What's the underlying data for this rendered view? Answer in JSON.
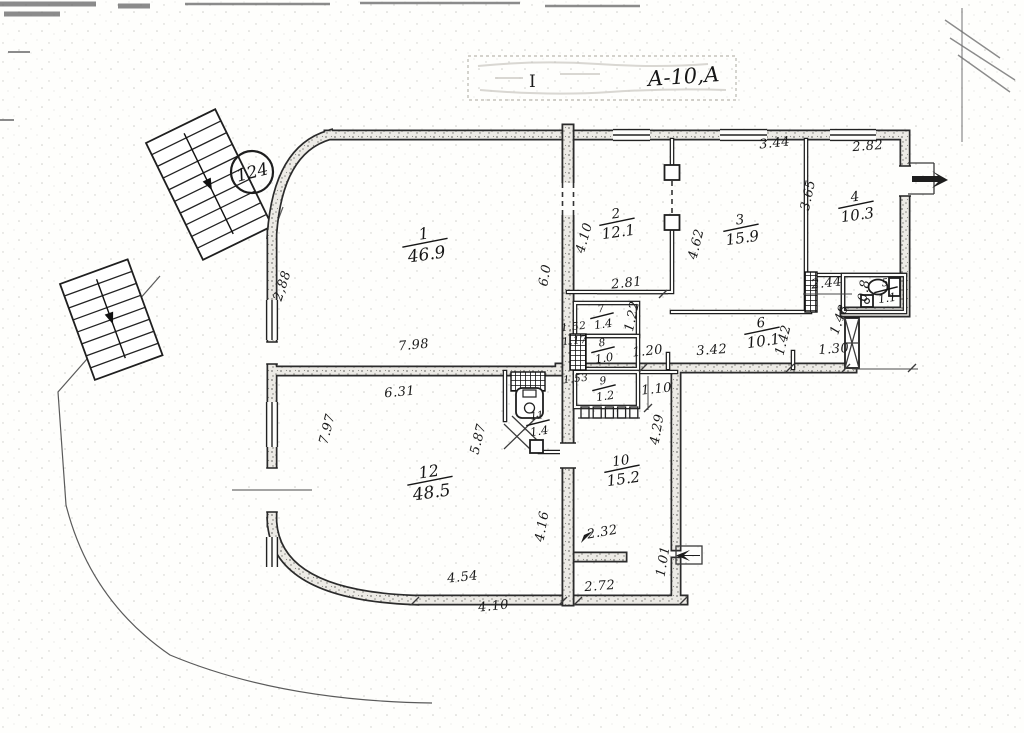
{
  "stamp": {
    "handwritten": "А-10,А",
    "mark": "I"
  },
  "unit_badge": {
    "number": "124"
  },
  "rooms": [
    {
      "num": "1",
      "area": "46.9",
      "x": 425,
      "y": 243,
      "rot": -8,
      "size": "lg"
    },
    {
      "num": "2",
      "area": "12.1",
      "x": 617,
      "y": 222,
      "rot": -8,
      "size": "md"
    },
    {
      "num": "3",
      "area": "15.9",
      "x": 741,
      "y": 228,
      "rot": -8,
      "size": "md"
    },
    {
      "num": "4",
      "area": "10.3",
      "x": 856,
      "y": 205,
      "rot": -8,
      "size": "md"
    },
    {
      "num": "5",
      "area": "1.1",
      "x": 886,
      "y": 290,
      "rot": -8,
      "size": "sm"
    },
    {
      "num": "6",
      "area": "10.1",
      "x": 762,
      "y": 331,
      "rot": -8,
      "size": "md"
    },
    {
      "num": "7",
      "area": "1.4",
      "x": 602,
      "y": 316,
      "rot": -8,
      "size": "sm"
    },
    {
      "num": "8",
      "area": "1.0",
      "x": 603,
      "y": 350,
      "rot": -8,
      "size": "sm"
    },
    {
      "num": "9",
      "area": "1.2",
      "x": 604,
      "y": 388,
      "rot": -8,
      "size": "sm"
    },
    {
      "num": "10",
      "area": "15.2",
      "x": 622,
      "y": 469,
      "rot": -8,
      "size": "md"
    },
    {
      "num": "11",
      "area": "1.4",
      "x": 538,
      "y": 423,
      "rot": -8,
      "size": "sm"
    },
    {
      "num": "12",
      "area": "48.5",
      "x": 430,
      "y": 481,
      "rot": -8,
      "size": "lg"
    }
  ],
  "dimensions": [
    {
      "text": "2,88",
      "x": 286,
      "y": 287,
      "rot": -72
    },
    {
      "text": "7.98",
      "x": 414,
      "y": 349,
      "rot": -5
    },
    {
      "text": "6.31",
      "x": 400,
      "y": 396,
      "rot": -5
    },
    {
      "text": "7.97",
      "x": 331,
      "y": 430,
      "rot": -76
    },
    {
      "text": "5.87",
      "x": 482,
      "y": 440,
      "rot": -76
    },
    {
      "text": "4.16",
      "x": 546,
      "y": 527,
      "rot": -80
    },
    {
      "text": "2.32",
      "x": 603,
      "y": 536,
      "rot": -10
    },
    {
      "text": "4.54",
      "x": 463,
      "y": 581,
      "rot": -6
    },
    {
      "text": "4.10",
      "x": 494,
      "y": 610,
      "rot": -6
    },
    {
      "text": "2.72",
      "x": 600,
      "y": 590,
      "rot": -4
    },
    {
      "text": "1.01",
      "x": 667,
      "y": 562,
      "rot": -80
    },
    {
      "text": "4.29",
      "x": 661,
      "y": 430,
      "rot": -80
    },
    {
      "text": "4.10",
      "x": 588,
      "y": 239,
      "rot": -74
    },
    {
      "text": "6.0",
      "x": 549,
      "y": 276,
      "rot": -80
    },
    {
      "text": "2.81",
      "x": 627,
      "y": 287,
      "rot": -6
    },
    {
      "text": "1.22",
      "x": 636,
      "y": 317,
      "rot": -78
    },
    {
      "text": "1.52",
      "x": 574,
      "y": 330,
      "rot": -6,
      "size": "xs"
    },
    {
      "text": "1.17",
      "x": 575,
      "y": 344,
      "rot": -6,
      "size": "xs"
    },
    {
      "text": "1.53",
      "x": 576,
      "y": 382,
      "rot": -6,
      "size": "xs"
    },
    {
      "text": "1.20",
      "x": 648,
      "y": 355,
      "rot": -6
    },
    {
      "text": "3.42",
      "x": 712,
      "y": 354,
      "rot": -4
    },
    {
      "text": "1.42",
      "x": 787,
      "y": 341,
      "rot": -76
    },
    {
      "text": "1.30",
      "x": 834,
      "y": 353,
      "rot": -4
    },
    {
      "text": "1.10",
      "x": 657,
      "y": 393,
      "rot": -6
    },
    {
      "text": "3.44",
      "x": 775,
      "y": 147,
      "rot": -6
    },
    {
      "text": "2.82",
      "x": 868,
      "y": 150,
      "rot": -4
    },
    {
      "text": "3.65",
      "x": 812,
      "y": 196,
      "rot": -78
    },
    {
      "text": "4.62",
      "x": 700,
      "y": 245,
      "rot": -76
    },
    {
      "text": "2.44",
      "x": 827,
      "y": 287,
      "rot": -6
    },
    {
      "text": "1.48",
      "x": 843,
      "y": 321,
      "rot": -70
    },
    {
      "text": "0.8",
      "x": 868,
      "y": 291,
      "rot": -82
    }
  ]
}
